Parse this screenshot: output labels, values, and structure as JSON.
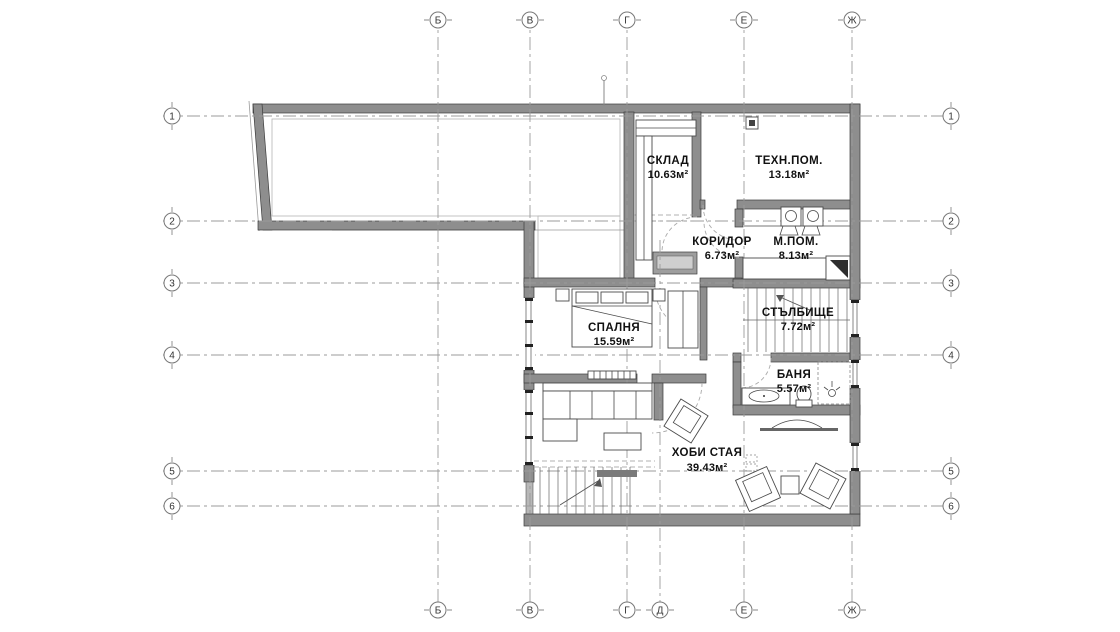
{
  "plan": {
    "rooms": [
      {
        "name": "СКЛАД",
        "area": "10.63м²"
      },
      {
        "name": "ТЕХН.ПОМ.",
        "area": "13.18м²"
      },
      {
        "name": "КОРИДОР",
        "area": "6.73м²"
      },
      {
        "name": "М.ПОМ.",
        "area": "8.13м²"
      },
      {
        "name": "СПАЛНЯ",
        "area": "15.59м²"
      },
      {
        "name": "СТЪЛБИЩЕ",
        "area": "7.72м²"
      },
      {
        "name": "БАНЯ",
        "area": "5.57м²"
      },
      {
        "name": "ХОБИ СТАЯ",
        "area": "39.43м²"
      }
    ],
    "grid_axes": {
      "top": [
        "Б",
        "В",
        "Г",
        "Е",
        "Ж"
      ],
      "bottom": [
        "Б",
        "В",
        "Г",
        "Д",
        "Е",
        "Ж"
      ],
      "left": [
        "1",
        "2",
        "3",
        "4",
        "5",
        "6"
      ],
      "right": [
        "1",
        "2",
        "3",
        "4",
        "5",
        "6"
      ]
    },
    "colors": {
      "wall": "#8e8e8e",
      "wall_edge": "#3c3c3c",
      "hatch_line": "#c9c9c9",
      "axis_line": "#9b9b9b",
      "text": "#111111",
      "background": "#ffffff"
    }
  }
}
